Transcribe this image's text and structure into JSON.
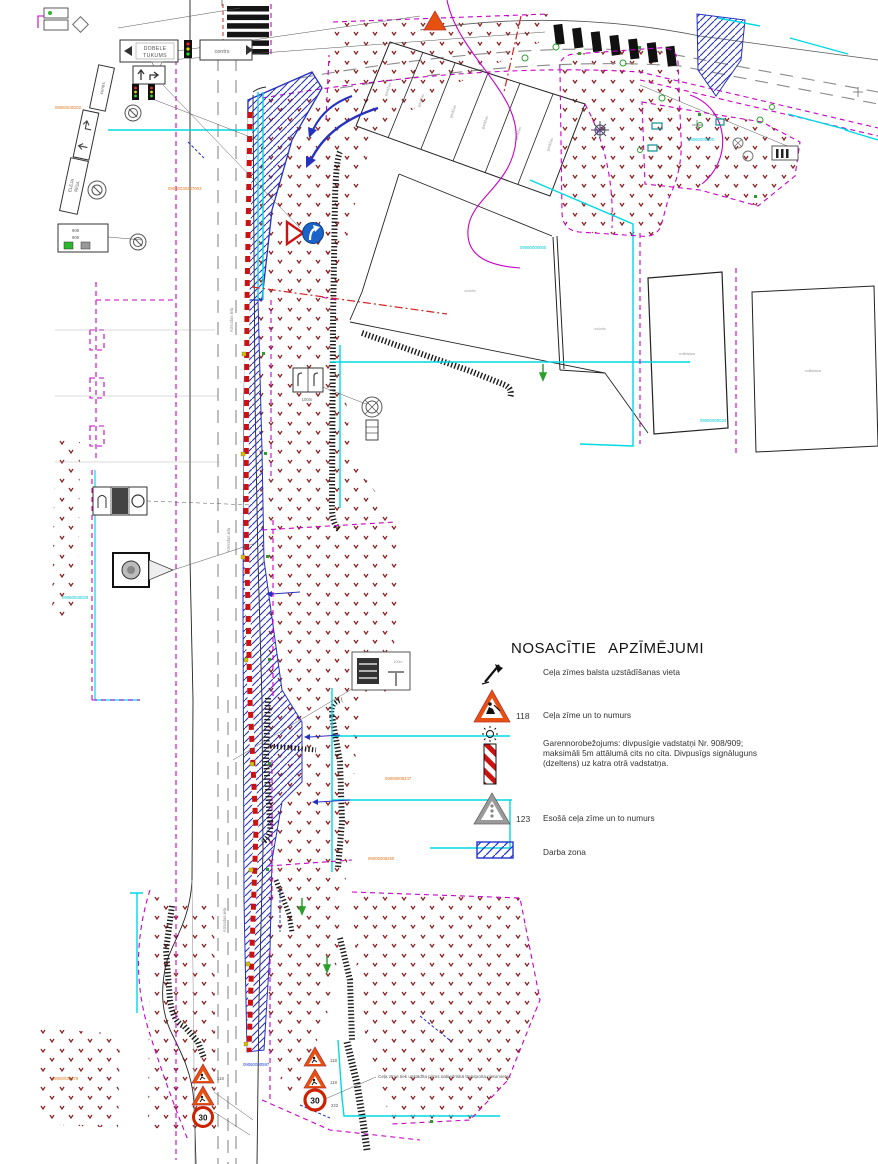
{
  "legend": {
    "title": "NOSACĪTIE APZĪMĒJUMI",
    "item1_text": "Ceļa zīmes balsta uzstādīšanas vieta",
    "item2_num": "118",
    "item2_text": "Ceļa zīme un to numurs",
    "item3_line1": "Garennorobežojums: divpusīgie vadstatņi Nr. 908/909;",
    "item3_line2": "maksimāli 5m attālumā cits no cita. Divpusīgs signāluguns",
    "item3_line3": "(dzeltens) uz katra otrā vadstatņa.",
    "item4_num": "123",
    "item4_text": "Esošā ceļa zīme un to numurs",
    "item5_text": "Darba zona"
  },
  "note": {
    "text": "Ceļa zīme tiek uzstādīta pirms sabiedriskā transporta pieturvietas"
  },
  "signs": {
    "dobele": "DOBELE",
    "tukums": "TUKUMS",
    "centrs": "centrs",
    "eleja": "ELEJA",
    "riga": "RĪGA",
    "speed30": "30",
    "num118": "118",
    "num222": "222",
    "dist100m": "100m",
    "post908": "908",
    "post909": "909"
  },
  "road": {
    "name": "Atmodas iela"
  },
  "area_labels": {
    "ground": "asfalts",
    "building": "noliktava",
    "garage": "garāžas"
  },
  "cadastral": {
    "c1": "09060030202",
    "c2": "09060030207003",
    "c3": "09060040028",
    "c4": "09060000000",
    "c5": "09060000000",
    "c6": "09008009347",
    "c7": "09008008250",
    "c8": "09060000597",
    "c9": "09060030179",
    "c10": "09060000034"
  },
  "colors": {
    "work_zone_blue": "#2531c0",
    "barrier_red": "#cc1111",
    "sign_orange": "#e8500f",
    "utility_cyan": "#00d8e4",
    "boundary_magenta": "#c800c8",
    "stipple_red": "#8b2222"
  }
}
